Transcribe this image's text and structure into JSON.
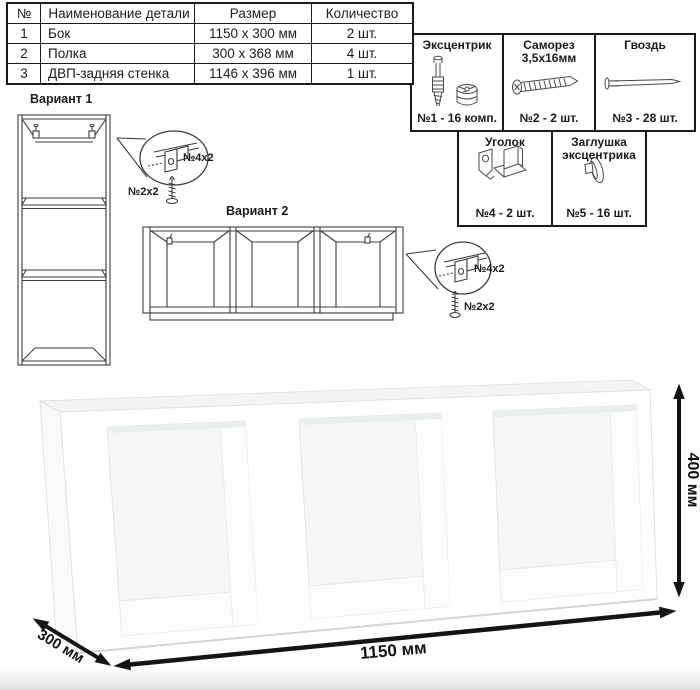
{
  "parts_table": {
    "headers": [
      "№",
      "Наименование детали",
      "Размер",
      "Количество"
    ],
    "rows": [
      {
        "num": "1",
        "name": "Бок",
        "size": "1150 x 300 мм",
        "qty": "2 шт."
      },
      {
        "num": "2",
        "name": "Полка",
        "size": "300 x 368 мм",
        "qty": "4 шт."
      },
      {
        "num": "3",
        "name": "ДВП-задняя стенка",
        "size": "1146 x 396 мм",
        "qty": "1 шт."
      }
    ]
  },
  "hardware": {
    "items": [
      {
        "line1": "Эксцентрик",
        "line2": "",
        "count": "№1 - 16 комп.",
        "icon": "cam-bolt-and-lock"
      },
      {
        "line1": "Саморез",
        "line2": "3,5х16мм",
        "count": "№2 - 2 шт.",
        "icon": "screw"
      },
      {
        "line1": "Гвоздь",
        "line2": "",
        "count": "№3 - 28 шт.",
        "icon": "nail"
      },
      {
        "line1": "Уголок",
        "line2": "",
        "count": "№4 - 2 шт.",
        "icon": "corner-bracket"
      },
      {
        "line1": "Заглушка",
        "line2": "эксцентрика",
        "count": "№5 - 16 шт.",
        "icon": "cam-cap"
      }
    ]
  },
  "variants": {
    "v1": {
      "title": "Вариант 1",
      "bracket_label": "№4х2",
      "screw_label": "№2х2"
    },
    "v2": {
      "title": "Вариант 2",
      "bracket_label": "№4х2",
      "screw_label": "№2х2"
    }
  },
  "dimensions": {
    "width": "1150 мм",
    "height": "400 мм",
    "depth": "300 мм"
  }
}
